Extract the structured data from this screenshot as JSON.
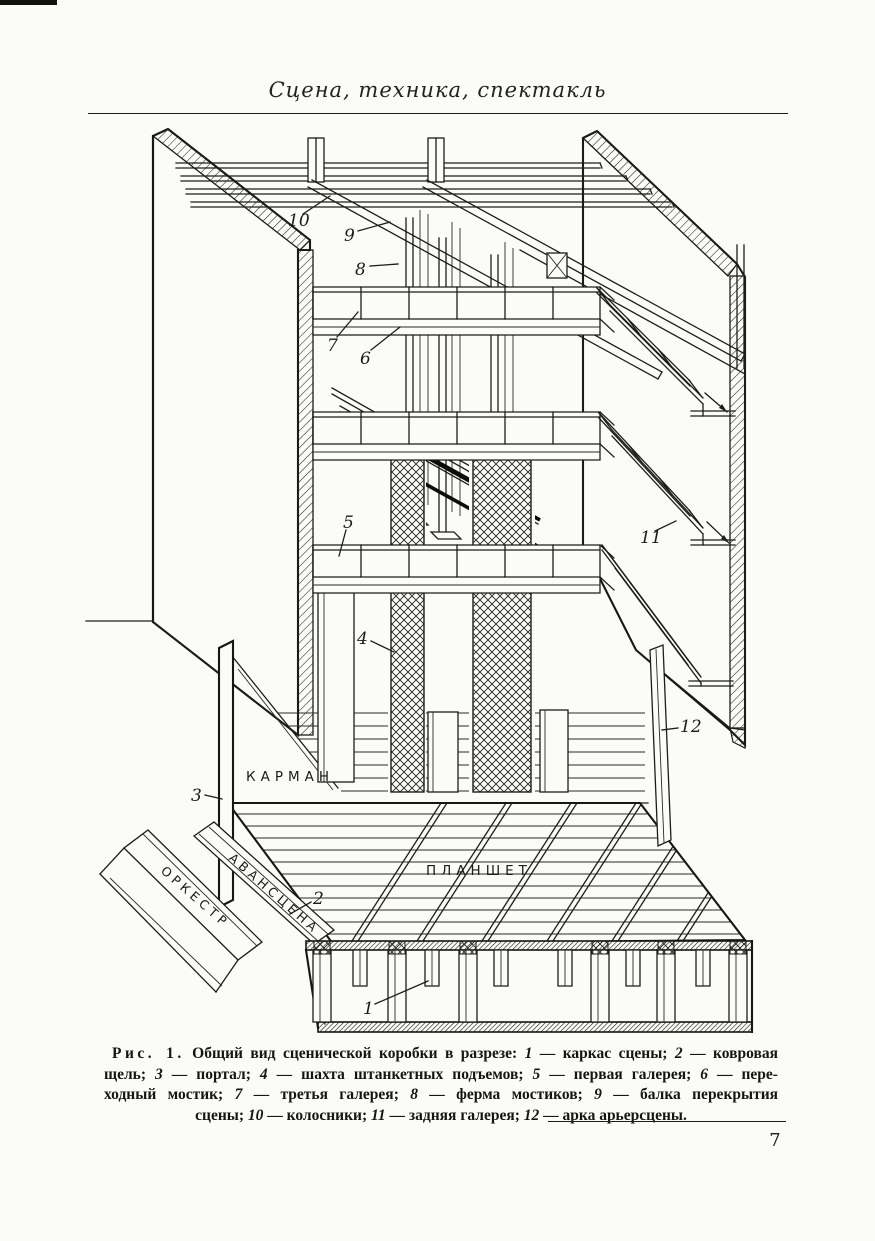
{
  "header": {
    "title": "Сцена, техника, спектакль"
  },
  "page": {
    "page_number": "7",
    "background": "#fbfbf8",
    "ink": "#1c1c1c"
  },
  "figure": {
    "labels": {
      "karman": "КАРМАН",
      "planshet": "ПЛАНШЕТ",
      "avanscena": "АВАНСЦЕНА",
      "orkestr": "ОРКЕСТР"
    },
    "callouts": {
      "n1": "1",
      "n2": "2",
      "n3": "3",
      "n4": "4",
      "n5": "5",
      "n6": "6",
      "n7": "7",
      "n8": "8",
      "n9": "9",
      "n10": "10",
      "n11": "11",
      "n12": "12"
    }
  },
  "caption": {
    "lines": [
      [
        {
          "t": "Рис. 1.",
          "cls": "rs"
        },
        {
          "t": " Общий вид сценической коробки в разрезе: "
        },
        {
          "t": "1",
          "i": 1
        },
        {
          "t": " — каркас сцены; "
        },
        {
          "t": "2",
          "i": 1
        },
        {
          "t": " — ковровая"
        }
      ],
      [
        {
          "t": "щель; "
        },
        {
          "t": "3",
          "i": 1
        },
        {
          "t": " — портал; "
        },
        {
          "t": "4",
          "i": 1
        },
        {
          "t": " — шахта штанкетных подъемов; "
        },
        {
          "t": "5",
          "i": 1
        },
        {
          "t": " — первая галерея; "
        },
        {
          "t": "6",
          "i": 1
        },
        {
          "t": " — пере-"
        }
      ],
      [
        {
          "t": "ходный мостик; "
        },
        {
          "t": "7",
          "i": 1
        },
        {
          "t": " — третья галерея; "
        },
        {
          "t": "8",
          "i": 1
        },
        {
          "t": " — ферма мостиков; "
        },
        {
          "t": "9",
          "i": 1
        },
        {
          "t": " — балка перекрытия"
        }
      ],
      [
        {
          "t": "сцены; "
        },
        {
          "t": "10",
          "i": 1
        },
        {
          "t": " — колосники; "
        },
        {
          "t": "11",
          "i": 1
        },
        {
          "t": " — задняя галерея; "
        },
        {
          "t": "12",
          "i": 1
        },
        {
          "t": " — арка арьерсцены."
        }
      ]
    ]
  }
}
